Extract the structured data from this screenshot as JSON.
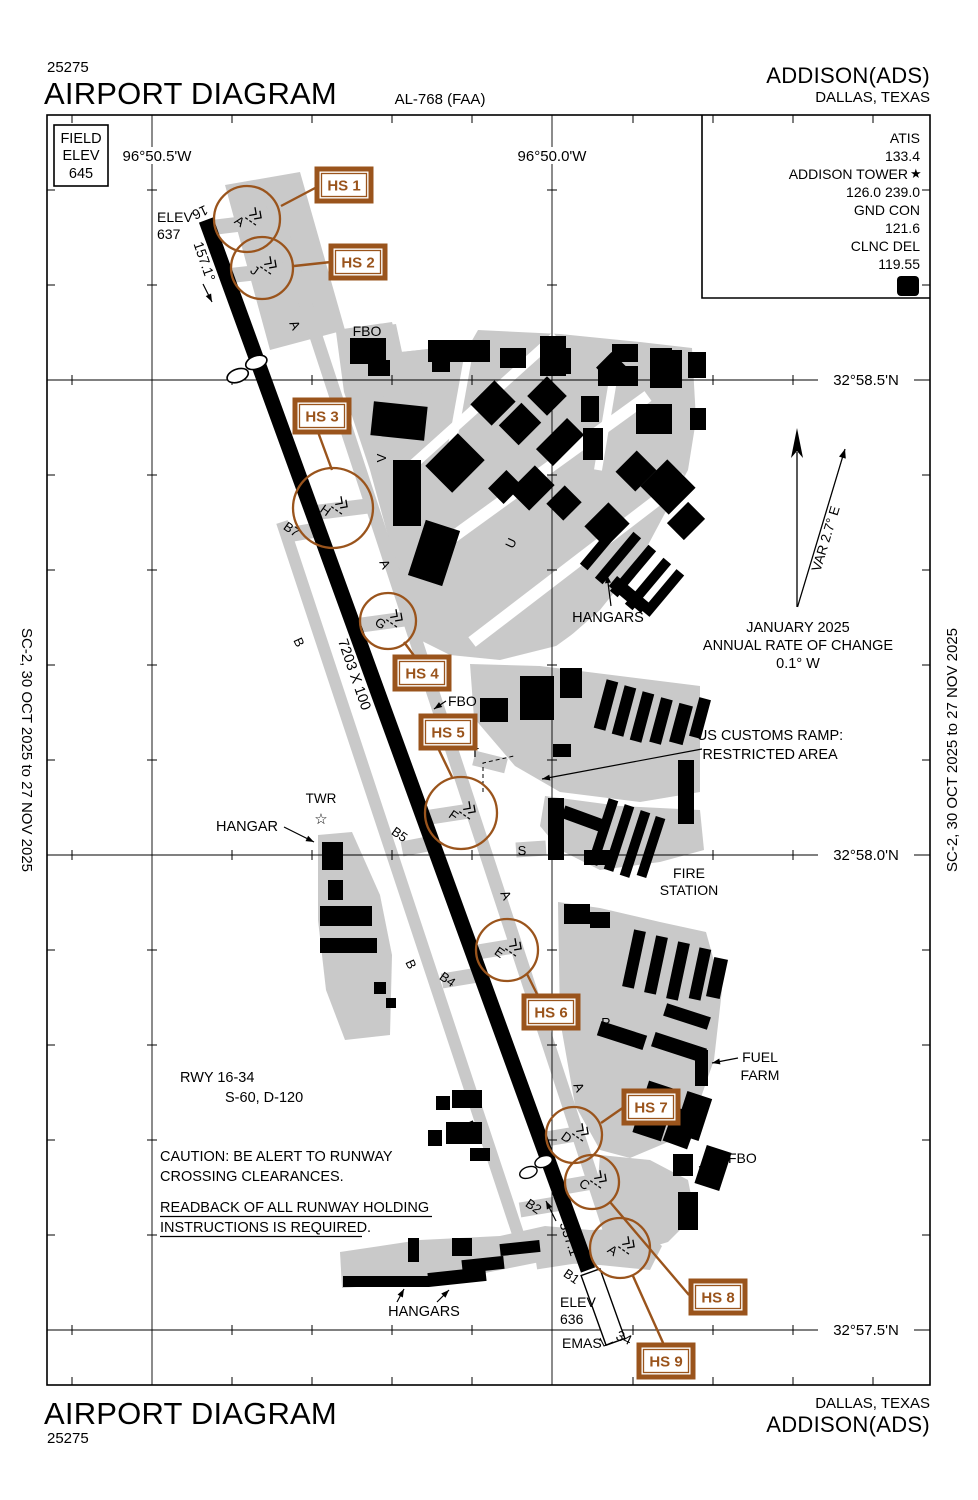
{
  "header": {
    "chart_code": "25275",
    "title": "AIRPORT DIAGRAM",
    "chart_ref": "AL-768 (FAA)",
    "airport_name": "ADDISON(ADS)",
    "city": "DALLAS, TEXAS"
  },
  "footer": {
    "title": "AIRPORT DIAGRAM",
    "chart_code": "25275",
    "city": "DALLAS, TEXAS",
    "airport_name": "ADDISON(ADS)"
  },
  "edge_note_left": "SC-2,  30 OCT 2025  to  27 NOV 2025",
  "edge_note_right": "SC-2,  30 OCT 2025  to  27 NOV 2025",
  "field_elev": {
    "label1": "FIELD",
    "label2": "ELEV",
    "value": "645"
  },
  "comm_box": {
    "atis_label": "ATIS",
    "atis": "133.4",
    "tower_label": "ADDISON TOWER",
    "tower_star": "★",
    "tower": "126.0  239.0",
    "gnd_label": "GND CON",
    "gnd": "121.6",
    "clnc_label": "CLNC DEL",
    "clnc": "119.55",
    "beacon": "D"
  },
  "graticule": {
    "lon1": "96°50.5'W",
    "lon2": "96°50.0'W",
    "lat1": "32°58.5'N",
    "lat2": "32°58.0'N",
    "lat3": "32°57.5'N"
  },
  "magvar": {
    "north_label": "VAR 2.7° E",
    "line1": "JANUARY 2025",
    "line2": "ANNUAL RATE OF CHANGE",
    "line3": "0.1° W"
  },
  "runway": {
    "id_north": "16",
    "id_south": "34",
    "elev_north_label": "ELEV",
    "elev_north": "637",
    "elev_south_label": "ELEV",
    "elev_south": "636",
    "hdg_south": "157.1°",
    "hdg_north": "337.1°",
    "dimensions": "7203 X 100",
    "emas": "EMAS",
    "data_line1": "RWY  16-34",
    "data_line2": "S-60, D-120"
  },
  "notes": {
    "caution1": "CAUTION:  BE ALERT TO RUNWAY",
    "caution2": "CROSSING CLEARANCES.",
    "readback1": "READBACK OF ALL RUNWAY HOLDING",
    "readback2": "INSTRUCTIONS IS REQUIRED."
  },
  "labels": {
    "fbo_north": "FBO",
    "fbo_mid": "FBO",
    "fbo_south": "FBO",
    "hangars_ne": "HANGARS",
    "hangar_west": "HANGAR",
    "hangars_sw": "HANGARS",
    "twr": "TWR",
    "fire1": "FIRE",
    "fire2": "STATION",
    "fuel1": "FUEL",
    "fuel2": "FARM",
    "customs1": "US CUSTOMS RAMP:",
    "customs2": "RESTRICTED AREA"
  },
  "icons": {
    "tower_star_symbol": "☆"
  },
  "taxiway_labels": [
    {
      "t": "A",
      "x": 291,
      "y": 327,
      "r": 65
    },
    {
      "t": "A",
      "x": 381,
      "y": 566,
      "r": 65
    },
    {
      "t": "A",
      "x": 502,
      "y": 897,
      "r": 65
    },
    {
      "t": "A",
      "x": 575,
      "y": 1089,
      "r": 65
    },
    {
      "t": "B",
      "x": 295,
      "y": 644,
      "r": 65
    },
    {
      "t": "B",
      "x": 407,
      "y": 966,
      "r": 65
    },
    {
      "t": "B",
      "x": 466,
      "y": 1127,
      "r": 65
    },
    {
      "t": "B7",
      "x": 289,
      "y": 533,
      "r": 35
    },
    {
      "t": "B5",
      "x": 397,
      "y": 838,
      "r": 35
    },
    {
      "t": "B4",
      "x": 445,
      "y": 983,
      "r": 35
    },
    {
      "t": "B2",
      "x": 531,
      "y": 1210,
      "r": 35
    },
    {
      "t": "B1",
      "x": 569,
      "y": 1280,
      "r": 35
    },
    {
      "t": "V",
      "x": 386,
      "y": 458,
      "r": -90
    },
    {
      "t": "U",
      "x": 515,
      "y": 545,
      "r": -65
    },
    {
      "t": "T",
      "x": 475,
      "y": 757,
      "r": 0
    },
    {
      "t": "S",
      "x": 522,
      "y": 855,
      "r": 0
    },
    {
      "t": "R",
      "x": 606,
      "y": 1027,
      "r": 0
    }
  ],
  "hotspots": {
    "boxes": [
      {
        "label": "HS 1",
        "x": 317,
        "y": 169
      },
      {
        "label": "HS 2",
        "x": 331,
        "y": 246
      },
      {
        "label": "HS 3",
        "x": 295,
        "y": 400
      },
      {
        "label": "HS 4",
        "x": 395,
        "y": 657
      },
      {
        "label": "HS 5",
        "x": 421,
        "y": 716
      },
      {
        "label": "HS 6",
        "x": 524,
        "y": 996
      },
      {
        "label": "HS 7",
        "x": 624,
        "y": 1091
      },
      {
        "label": "HS 8",
        "x": 691,
        "y": 1281
      },
      {
        "label": "HS 9",
        "x": 639,
        "y": 1345
      }
    ],
    "circles": [
      {
        "letter": "A",
        "cx": 247,
        "cy": 219,
        "r": 33
      },
      {
        "letter": "J",
        "cx": 262,
        "cy": 268,
        "r": 31
      },
      {
        "letter": "H",
        "cx": 333,
        "cy": 508,
        "r": 40
      },
      {
        "letter": "G",
        "cx": 388,
        "cy": 621,
        "r": 28
      },
      {
        "letter": "F",
        "cx": 461,
        "cy": 813,
        "r": 36
      },
      {
        "letter": "E",
        "cx": 507,
        "cy": 950,
        "r": 31
      },
      {
        "letter": "D",
        "cx": 574,
        "cy": 1135,
        "r": 28
      },
      {
        "letter": "C",
        "cx": 592,
        "cy": 1182,
        "r": 27
      },
      {
        "letter": "A",
        "cx": 620,
        "cy": 1248,
        "r": 30
      }
    ]
  },
  "colors": {
    "hotspot_brown": "#9a541c",
    "pavement_gray": "#c9c9c9",
    "building_black": "#000000"
  }
}
